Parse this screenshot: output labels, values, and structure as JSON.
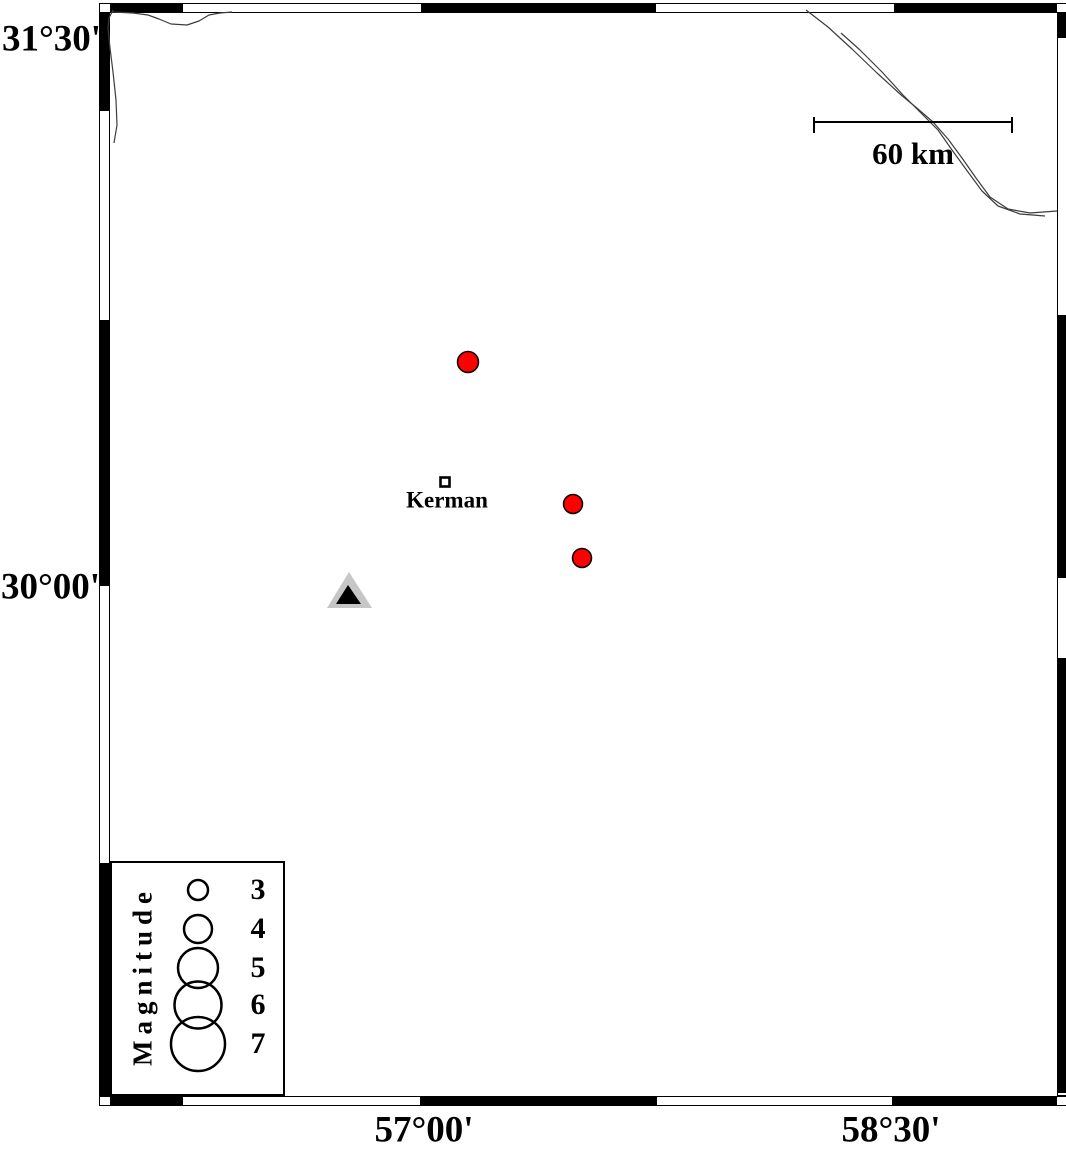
{
  "axis": {
    "left_labels": [
      {
        "text": "31°30'"
      },
      {
        "text": "30°00'"
      }
    ],
    "bottom_labels": [
      {
        "text": "57°00'"
      },
      {
        "text": "58°30'"
      }
    ]
  },
  "scale_bar": {
    "label": "60 km",
    "x1": 814,
    "x2": 1012,
    "y": 122,
    "tick_top": 117,
    "tick_bottom": 133
  },
  "city": {
    "name": "Kerman",
    "marker": {
      "x": 440.5,
      "y": 477.5,
      "size": 9
    }
  },
  "legend": {
    "title": "Magnitude",
    "circle_cx": 198,
    "entries": [
      {
        "magnitude": "3",
        "y": 890,
        "r": 10
      },
      {
        "magnitude": "4",
        "y": 929,
        "r": 14
      },
      {
        "magnitude": "5",
        "y": 968,
        "r": 20
      },
      {
        "magnitude": "6",
        "y": 1005,
        "r": 23.5
      },
      {
        "magnitude": "7",
        "y": 1044,
        "r": 27
      }
    ]
  },
  "map_data": {
    "type": "map",
    "description": "Epicenter map around Kerman with magnitude legend and 60 km scale bar",
    "earthquakes": [
      {
        "x": 468,
        "y": 362,
        "r": 10.5,
        "approx_magnitude": 3
      },
      {
        "x": 573,
        "y": 504,
        "r": 9.5,
        "approx_magnitude": 3
      },
      {
        "x": 582,
        "y": 558,
        "r": 9.5,
        "approx_magnitude": 3
      }
    ],
    "station": {
      "outer_points": [
        [
          349,
          572
        ],
        [
          327,
          608
        ],
        [
          372,
          608
        ]
      ],
      "inner_points": [
        [
          348,
          585
        ],
        [
          336,
          604
        ],
        [
          361,
          604
        ]
      ]
    },
    "fault_lines": [
      {
        "points": [
          [
            113,
            10
          ],
          [
            109,
            18
          ],
          [
            108,
            28
          ],
          [
            110,
            48
          ],
          [
            113,
            72
          ],
          [
            116,
            100
          ],
          [
            117,
            125
          ],
          [
            114,
            143
          ]
        ]
      },
      {
        "points": [
          [
            112,
            12
          ],
          [
            133,
            13
          ],
          [
            148,
            15
          ],
          [
            159,
            19
          ],
          [
            171,
            24
          ],
          [
            187,
            25
          ],
          [
            199,
            21
          ],
          [
            209,
            15
          ],
          [
            220,
            13
          ],
          [
            232,
            12
          ]
        ]
      },
      {
        "points": [
          [
            806,
            10
          ],
          [
            828,
            27
          ],
          [
            852,
            49
          ],
          [
            877,
            73
          ],
          [
            900,
            94
          ],
          [
            918,
            109
          ],
          [
            933,
            122
          ],
          [
            948,
            139
          ],
          [
            962,
            158
          ],
          [
            976,
            178
          ],
          [
            990,
            197
          ],
          [
            1008,
            209
          ],
          [
            1030,
            213
          ],
          [
            1057,
            211
          ]
        ]
      },
      {
        "points": [
          [
            841,
            33
          ],
          [
            860,
            50
          ],
          [
            882,
            72
          ],
          [
            903,
            95
          ],
          [
            920,
            112
          ],
          [
            938,
            130
          ],
          [
            952,
            150
          ],
          [
            968,
            172
          ],
          [
            982,
            191
          ],
          [
            998,
            206
          ],
          [
            1020,
            214
          ],
          [
            1045,
            216
          ]
        ]
      }
    ],
    "colors": {
      "earthquake": "#ff0000",
      "outline": "#000000",
      "station_outer": "#c6c6c6",
      "station_inner": "#000000",
      "fault_line": "#3d3d3d"
    }
  }
}
